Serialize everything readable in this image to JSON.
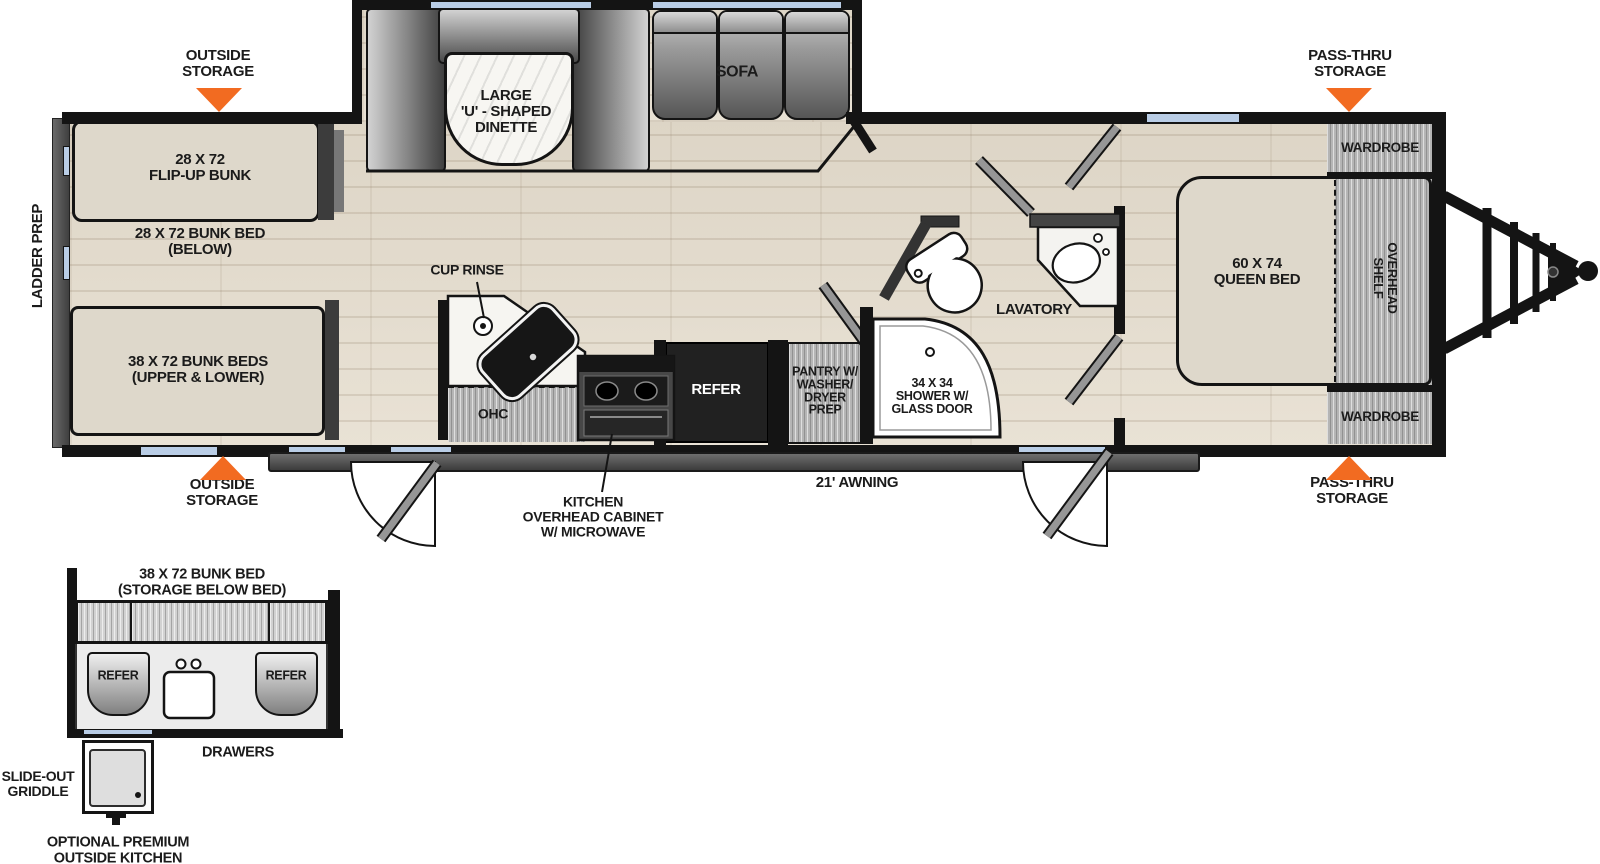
{
  "colors": {
    "accent": "#F26B21",
    "wall": "#141414",
    "window": "#B9CDE6",
    "floor": "#E4DDD0"
  },
  "callouts": {
    "outside_storage_top": "OUTSIDE\nSTORAGE",
    "pass_thru_storage_top": "PASS-THRU\nSTORAGE",
    "outside_storage_bottom": "OUTSIDE\nSTORAGE",
    "pass_thru_storage_bottom": "PASS-THRU\nSTORAGE",
    "ladder_prep": "LADDER PREP",
    "awning": "21' AWNING",
    "kitchen_overhead_cabinet": "KITCHEN\nOVERHEAD CABINET\nW/ MICROWAVE",
    "cup_rinse": "CUP RINSE"
  },
  "bunkhouse": {
    "flip_up_bunk": "28 X 72\nFLIP-UP BUNK",
    "bunk_bed_below": "28 X 72 BUNK BED\n(BELOW)",
    "bunk_beds_upper_lower": "38 X 72 BUNK BEDS\n(UPPER & LOWER)"
  },
  "living_area": {
    "dinette": "LARGE\n'U' - SHAPED\nDINETTE",
    "sofa": "SOFA"
  },
  "kitchen": {
    "ohc": "OHC",
    "refer": "REFER",
    "pantry": "PANTRY W/\nWASHER/\nDRYER\nPREP"
  },
  "bathroom": {
    "shower": "34 X 34\nSHOWER W/\nGLASS DOOR",
    "lavatory": "LAVATORY"
  },
  "bedroom": {
    "queen_bed": "60 X 74\nQUEEN BED",
    "wardrobe_front": "WARDROBE",
    "wardrobe_rear": "WARDROBE",
    "overhead_shelf": "OVERHEAD\nSHELF"
  },
  "outside_kitchen": {
    "title": "38 X 72 BUNK BED\n(STORAGE BELOW BED)",
    "refer_left": "REFER",
    "refer_right": "REFER",
    "drawers": "DRAWERS",
    "slide_out_griddle": "SLIDE-OUT\nGRIDDLE",
    "caption": "OPTIONAL PREMIUM\nOUTSIDE KITCHEN"
  }
}
